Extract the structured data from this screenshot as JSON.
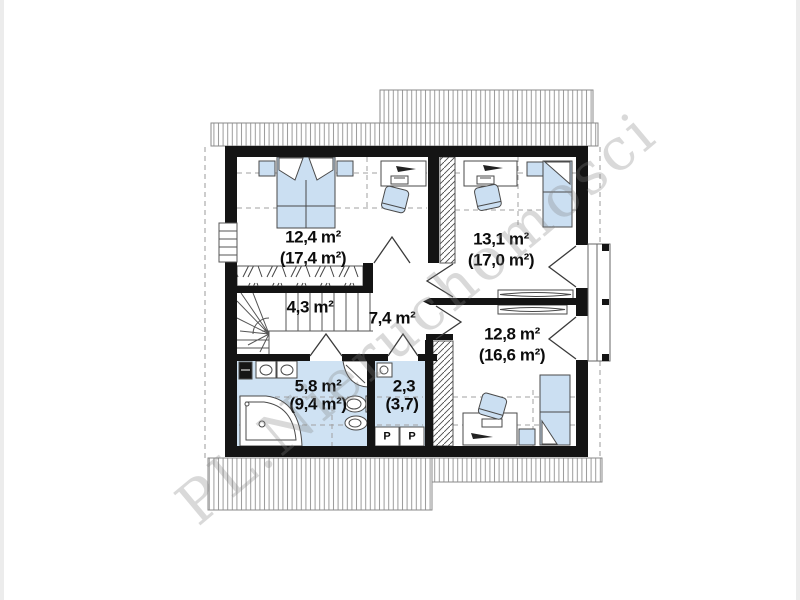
{
  "watermark": {
    "text": "PL.Nieruchomosci"
  },
  "rooms": [
    {
      "id": "bedroom-1",
      "area": "12,4 m²",
      "area_total": "(17,4 m²)"
    },
    {
      "id": "bedroom-2",
      "area": "13,1 m²",
      "area_total": "(17,0 m²)"
    },
    {
      "id": "staircase",
      "area": "4,3 m²",
      "area_total": ""
    },
    {
      "id": "hall",
      "area": "7,4 m²",
      "area_total": ""
    },
    {
      "id": "bedroom-3",
      "area": "12,8 m²",
      "area_total": "(16,6 m²)"
    },
    {
      "id": "bathroom",
      "area": "5,8 m²",
      "area_total": "(9,4 m²)"
    },
    {
      "id": "wc",
      "area": "2,3",
      "area_total": "(3,7)"
    }
  ],
  "appliances": [
    {
      "label": "P"
    },
    {
      "label": "P"
    }
  ],
  "colors": {
    "wall": "#141414",
    "furniture_fill": "#cbdff2",
    "wet_room_fill": "#cfe2f3",
    "roof_hatch": "#9a9a9a",
    "watermark_gray": "#808080"
  }
}
